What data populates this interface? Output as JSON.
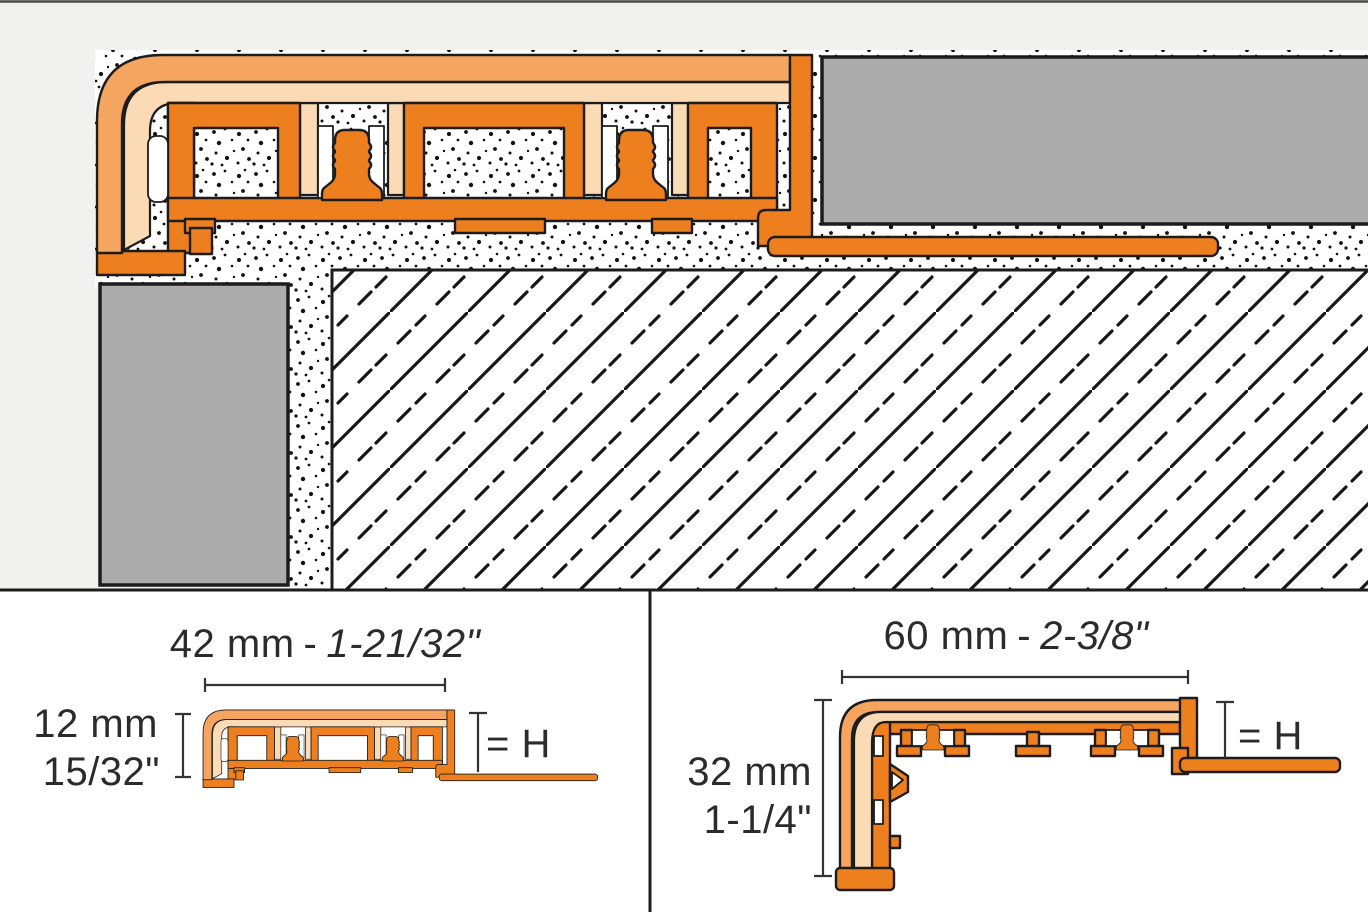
{
  "diagram_title": "Profile installation cross-section with dimension views",
  "colors": {
    "background_top": "#f1f1f0",
    "panel_bottom": "#ffffff",
    "profile_orange": "#ee7f1e",
    "profile_orange_medium": "#f5a55f",
    "profile_peach": "#fbdbb5",
    "tile_gray": "#acacac",
    "outline": "#1c1c1c",
    "dimension": "#333333",
    "text": "#2b2b2b"
  },
  "main_diagram": {
    "elements": [
      "edge profile with vinyl insert",
      "tile covering (top)",
      "tile covering (riser)",
      "thin-set mortar (stippled)",
      "substrate (hatched)",
      "perforated anchoring leg"
    ]
  },
  "dimension_panels": {
    "left": {
      "width_metric": "42 mm",
      "width_separator": "-",
      "width_imperial": "1-21/32\"",
      "height_metric": "12 mm",
      "height_imperial": "15/32\"",
      "height_reference": "= H"
    },
    "right": {
      "width_metric": "60 mm",
      "width_separator": "-",
      "width_imperial": "2-3/8\"",
      "height_metric": "32 mm",
      "height_imperial": "1-1/4\"",
      "height_reference": "= H"
    }
  }
}
